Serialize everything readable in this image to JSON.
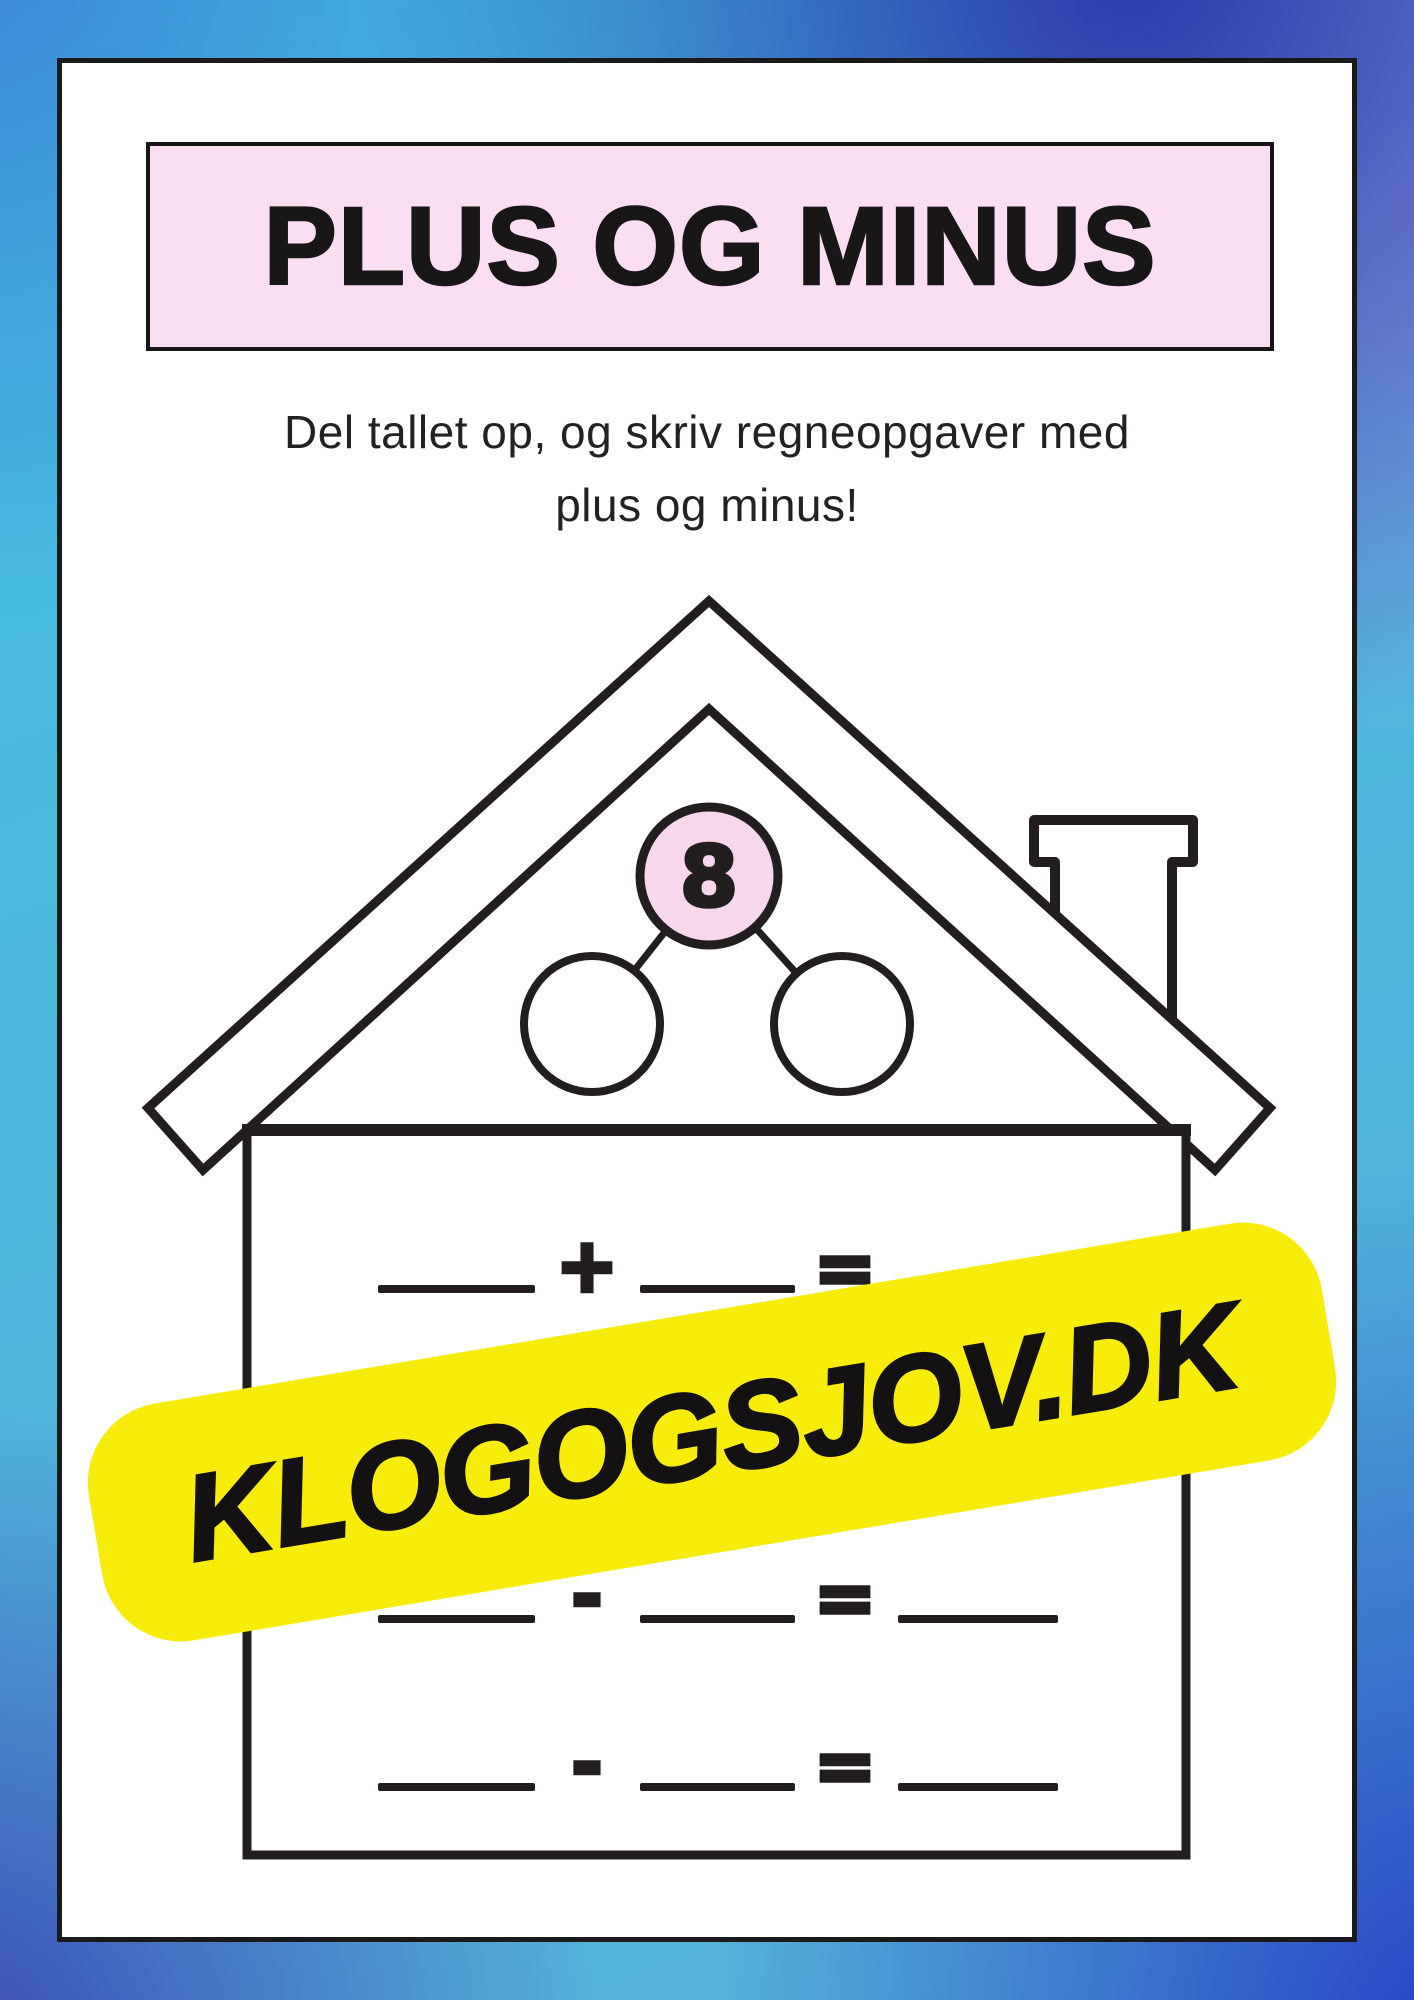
{
  "title": {
    "text": "PLUS OG MINUS"
  },
  "instructions": {
    "line1": "Del tallet op, og skriv regneopgaver med",
    "line2": "plus og minus!"
  },
  "house": {
    "bond": {
      "total": "8"
    },
    "rows": [
      {
        "operator": "+",
        "equals": "="
      },
      {
        "operator": "-",
        "equals": "="
      },
      {
        "operator": "-",
        "equals": "="
      }
    ]
  },
  "watermark": {
    "text": "KLOGOGSJOV.DK"
  },
  "colors": {
    "title_box_background": "#fcdef2",
    "bond_circle_fill": "#f8d7ed",
    "watermark_background": "#f8ec0a",
    "ink": "#221e1f",
    "border_gradient_top_left": "#3c86d8",
    "border_gradient_top_cyan": "#41c0e2",
    "border_gradient_top_right_indigo": "#2b36ac",
    "border_gradient_right_periwinkle": "#99a2e2",
    "border_gradient_bottom_right": "#2640c4",
    "border_gradient_bottom_left": "#3c4bb6"
  }
}
